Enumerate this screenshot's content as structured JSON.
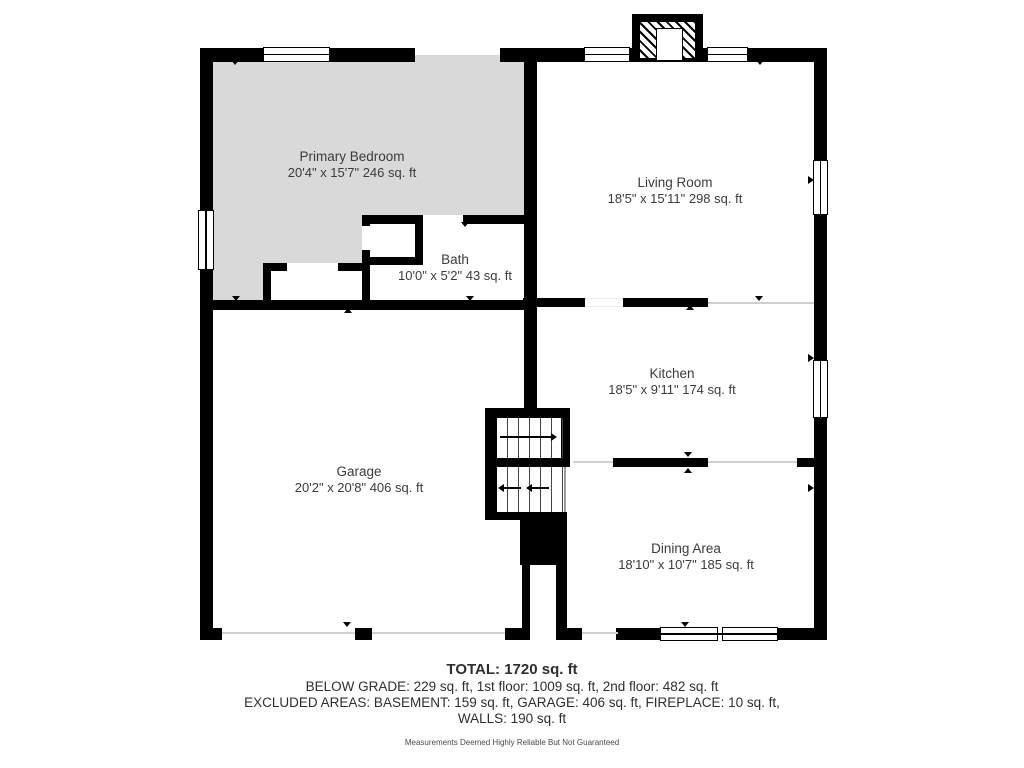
{
  "rooms": [
    {
      "name": "Primary Bedroom",
      "dims": "20'4\" x 15'7\" 246 sq. ft"
    },
    {
      "name": "Living Room",
      "dims": "18'5\" x 15'11\" 298 sq. ft"
    },
    {
      "name": "Bath",
      "dims": "10'0\" x 5'2\" 43 sq. ft"
    },
    {
      "name": "Kitchen",
      "dims": "18'5\" x 9'11\" 174 sq. ft"
    },
    {
      "name": "Garage",
      "dims": "20'2\" x 20'8\" 406 sq. ft"
    },
    {
      "name": "Dining Area",
      "dims": "18'10\" x 10'7\" 185 sq. ft"
    }
  ],
  "summary": {
    "total": "TOTAL: 1720 sq. ft",
    "line1": "BELOW GRADE: 229 sq. ft, 1st floor: 1009 sq. ft, 2nd floor: 482 sq. ft",
    "line2": "EXCLUDED AREAS: BASEMENT: 159 sq. ft, GARAGE: 406 sq. ft, FIREPLACE: 10 sq. ft,",
    "line3": "WALLS: 190 sq. ft",
    "disclaimer": "Measurements Deemed Highly Reliable But Not Guaranteed"
  },
  "colors": {
    "wall": "#000000",
    "bedroom_fill": "#d9d9d9",
    "label_text": "#3b3b3b",
    "background": "#ffffff"
  }
}
